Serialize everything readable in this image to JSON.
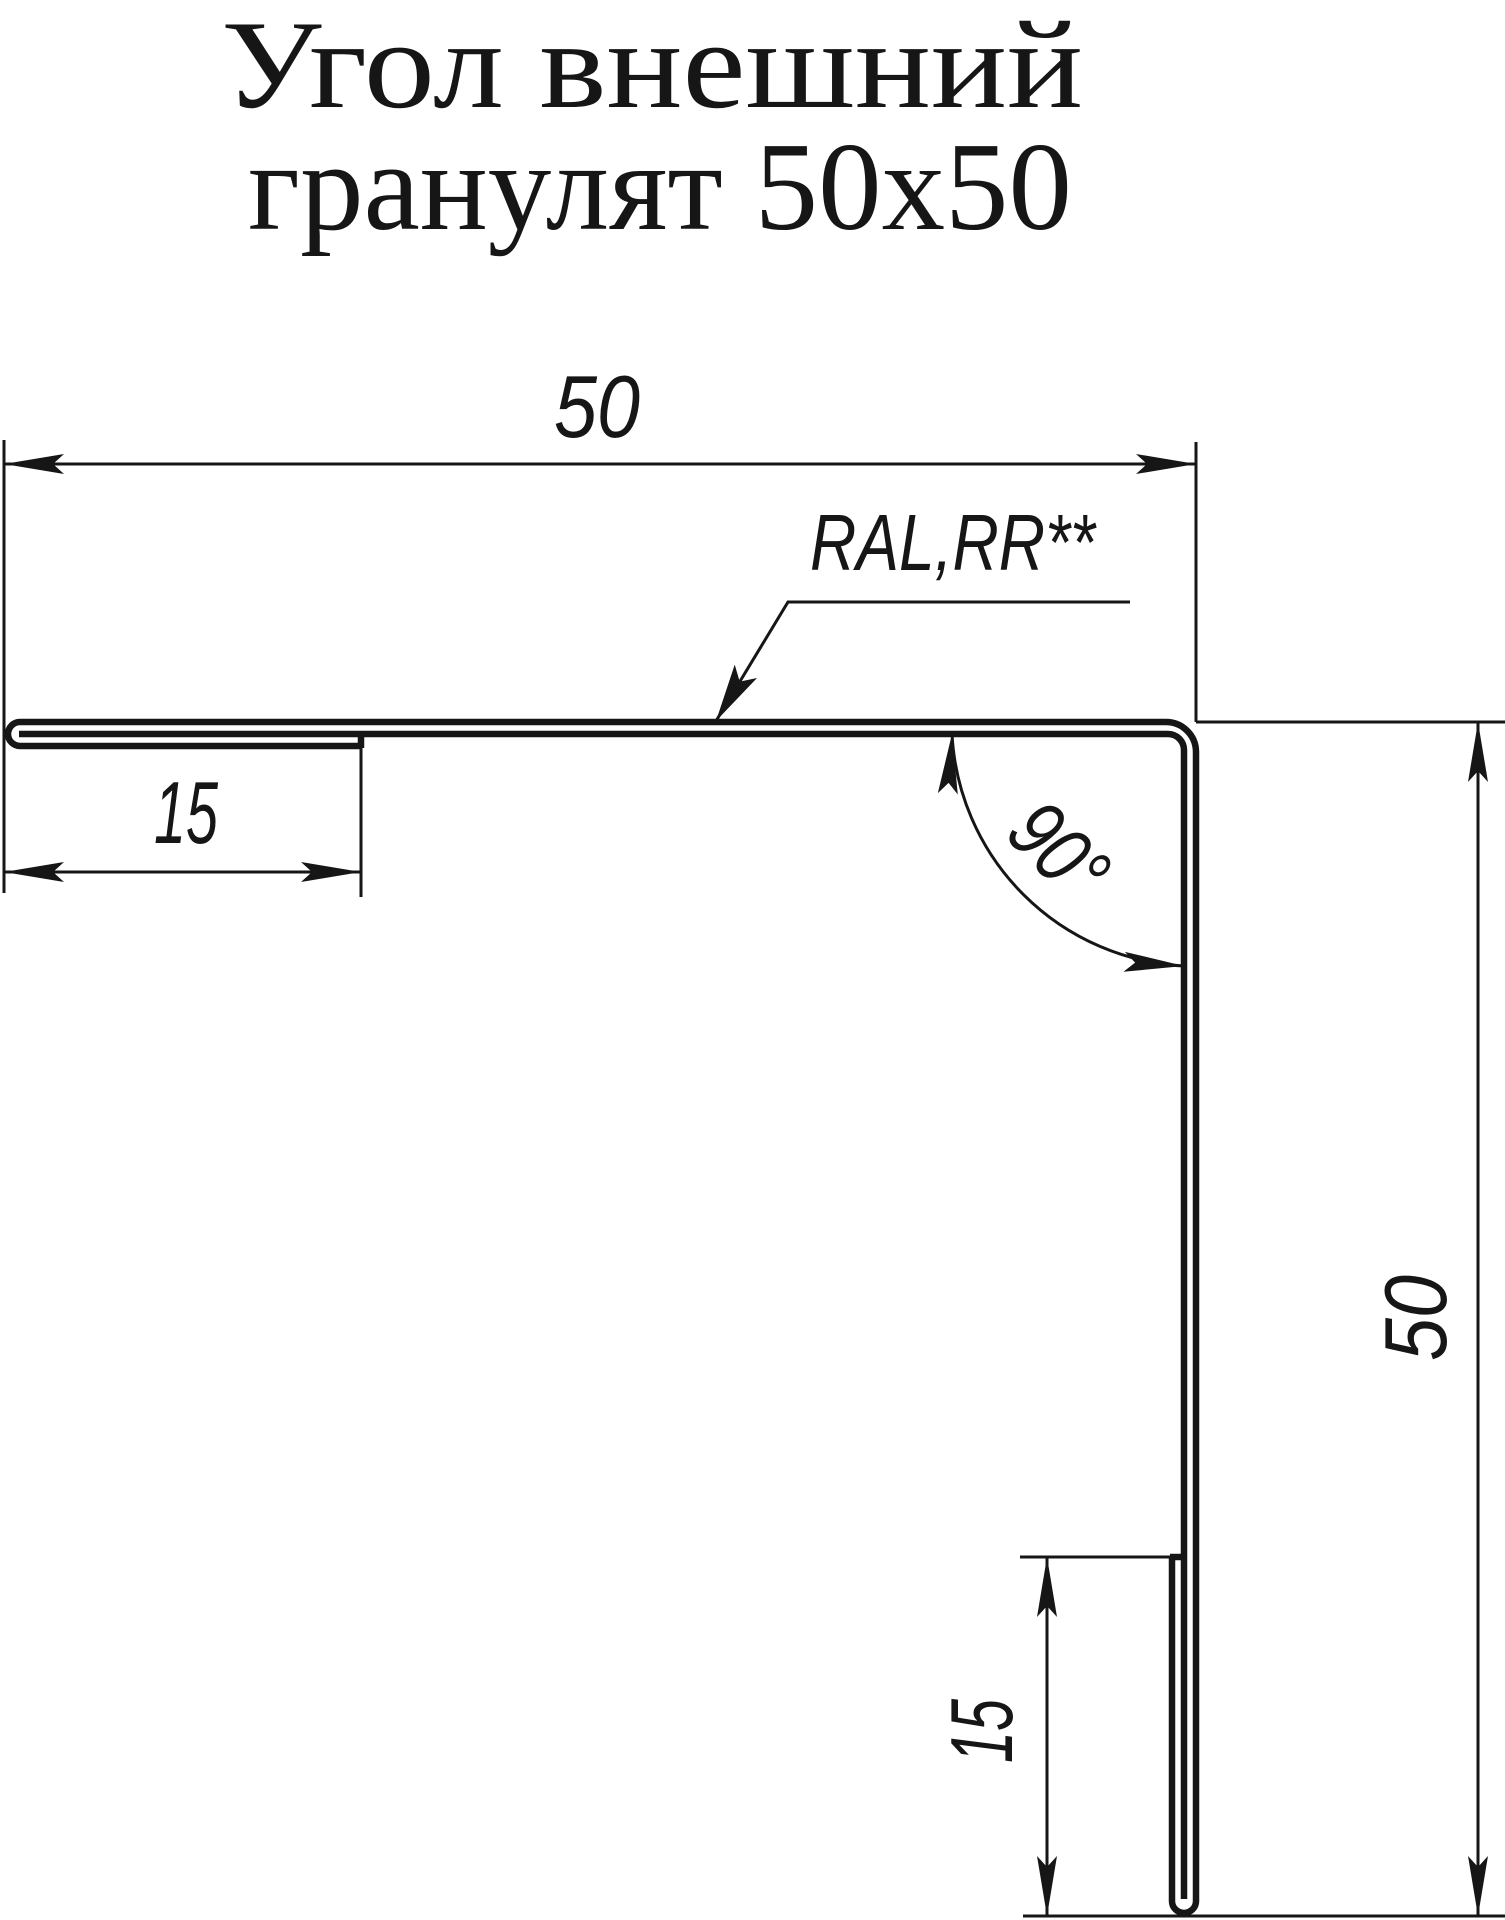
{
  "title": {
    "line1": "Угол внешний",
    "line2": "гранулят 50x50"
  },
  "annotations": {
    "coating_label": "RAL,RR**",
    "angle_label": "90°"
  },
  "dimensions": {
    "top_width": "50",
    "right_height": "50",
    "left_hem": "15",
    "bottom_hem": "15"
  },
  "colors": {
    "line": "#161616",
    "background": "#ffffff"
  }
}
